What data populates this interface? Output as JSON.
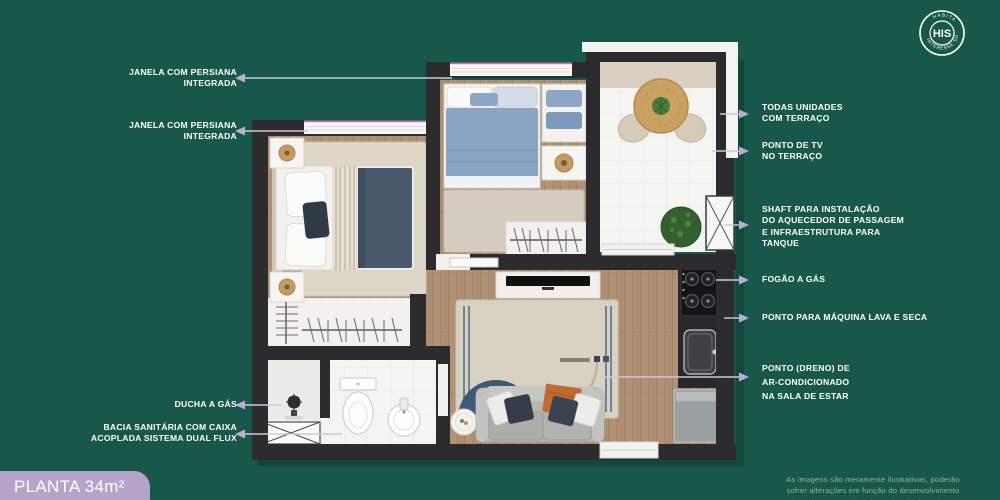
{
  "badge": {
    "title": "PLANTA 34m² (A)"
  },
  "logo": {
    "center": "HIS",
    "arc_top": "HABITAÇÃO DE",
    "arc_bottom": "INTERESSE SOCIAL"
  },
  "annotations": {
    "left": [
      {
        "text": "JANELA COM PERSIANA\nINTEGRADA"
      },
      {
        "text": "JANELA COM PERSIANA\nINTEGRADA"
      },
      {
        "text": "DUCHA A GÁS"
      },
      {
        "text": "BACIA SANITÁRIA COM CAIXA\nACOPLADA SISTEMA DUAL FLUX"
      }
    ],
    "right": [
      {
        "text": "TODAS UNIDADES\nCOM TERRAÇO"
      },
      {
        "text": "PONTO DE TV\nNO TERRAÇO"
      },
      {
        "text": "SHAFT PARA INSTALAÇÃO\nDO AQUECEDOR DE PASSAGEM\nE INFRAESTRUTURA PARA\nTANQUE"
      },
      {
        "text": "FOGÃO A GÁS"
      },
      {
        "text": "PONTO PARA MÁQUINA LAVA E SECA"
      },
      {
        "text": "PONTO (DRENO) DE\nAR-CONDICIONADO\nNA SALA DE ESTAR"
      }
    ]
  },
  "disclaimer": {
    "text": "As imagens são meramente ilustrativas, poderão\nsofrer alterações em função do desenvolvimento\ndo projeto e questões de cunho técnico e legal."
  },
  "colors": {
    "background": "#17584a",
    "badge": "#b6a4c8",
    "label_text": "#ffffff",
    "arrow_line": "#cfc6de",
    "wall": "#2c2c2e",
    "wood_floor": "#b29274",
    "tile_floor": "#f4f4f1",
    "rug": "#d9d2c3",
    "navy_accent": "#3c5a77",
    "orange_accent": "#c06a31",
    "window_line": "#b878ac",
    "disclaimer_text": "#8fb3a7"
  }
}
